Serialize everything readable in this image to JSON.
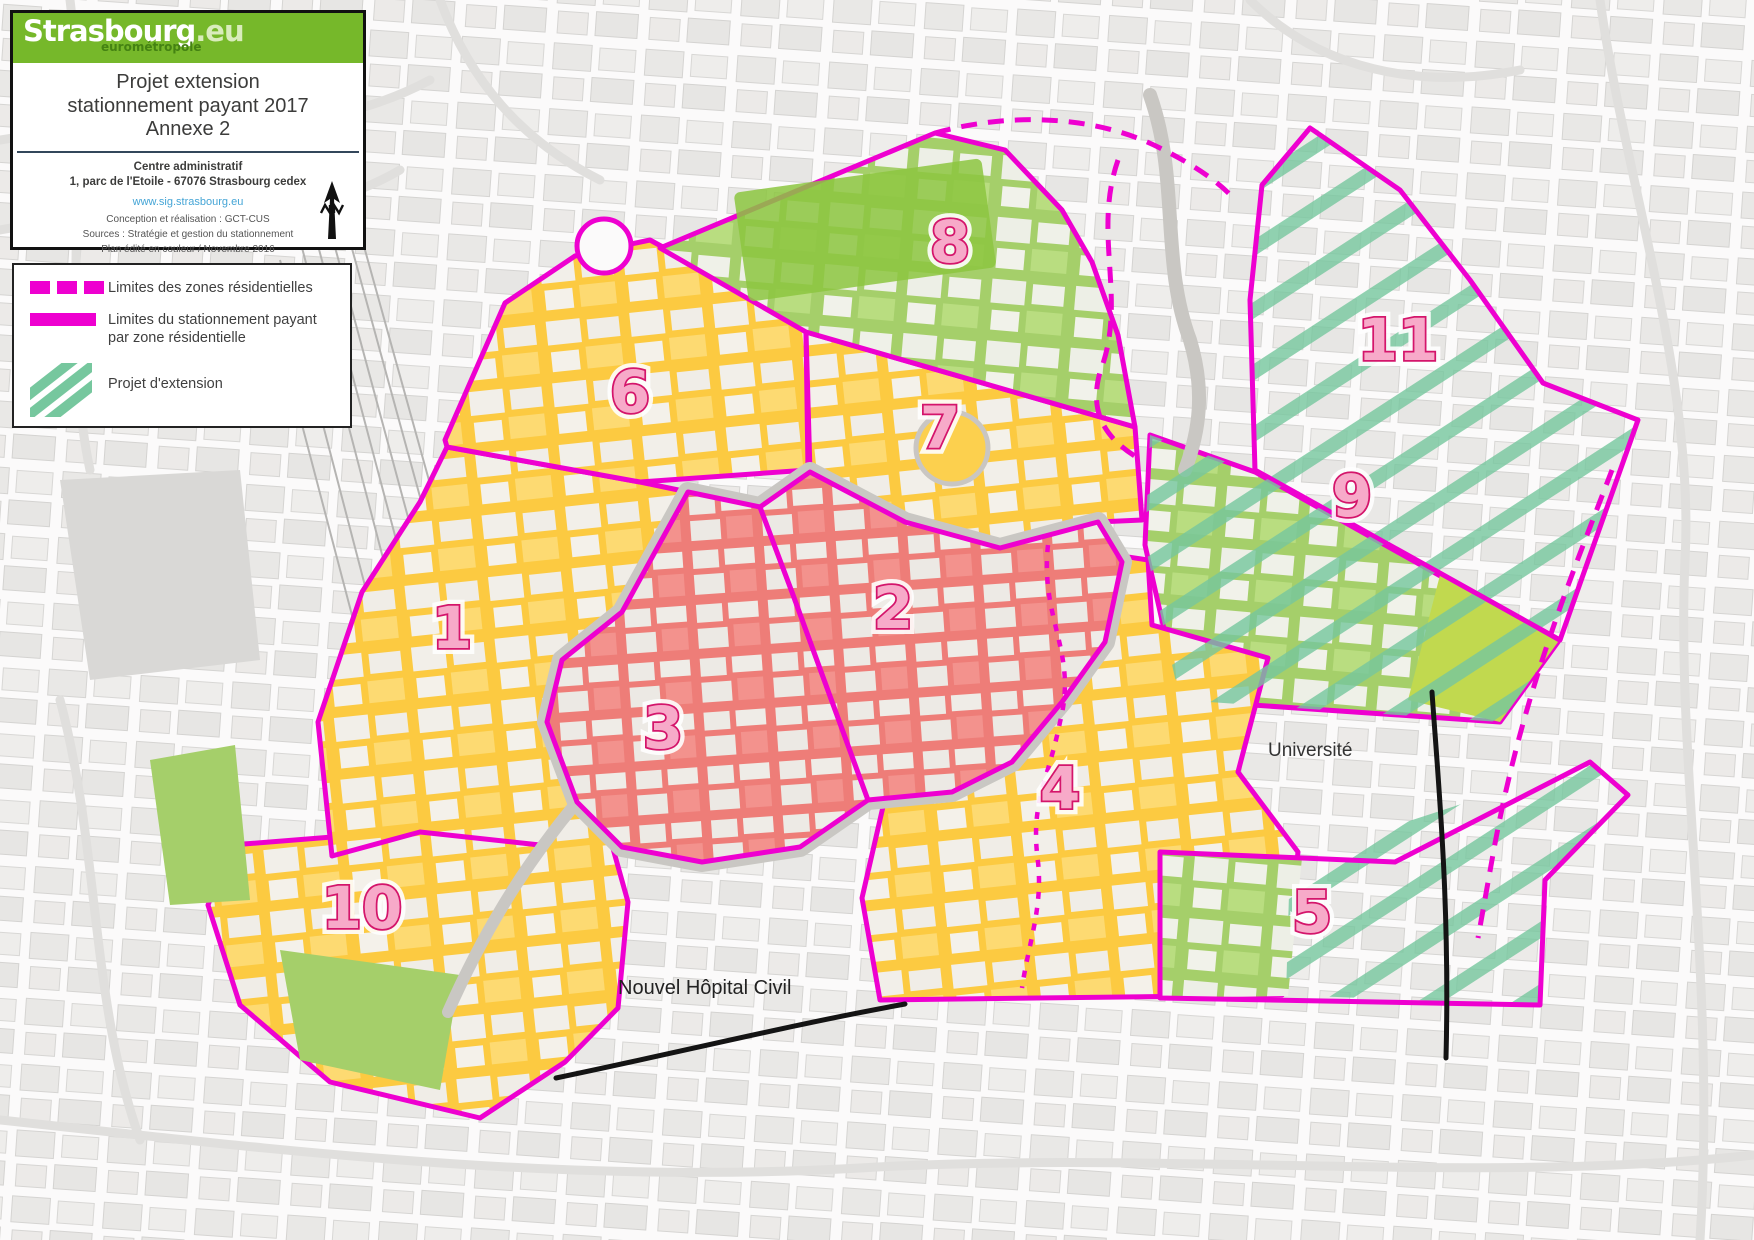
{
  "page_title": "Projet extension stationnement payant 2017 - Annexe 2",
  "title_box": {
    "logo_brand": "Strasbourg",
    "logo_tld": ".eu",
    "logo_subbrand": "eurométropole",
    "title_line1": "Projet extension",
    "title_line2": "stationnement payant 2017",
    "title_line3": "Annexe 2",
    "address_line1": "Centre administratif",
    "address_line2": "1, parc de l'Etoile - 67076 Strasbourg cedex",
    "website": "www.sig.strasbourg.eu",
    "credit_line1": "Conception et réalisation : GCT-CUS",
    "credit_line2": "Sources : Stratégie et gestion du stationnement",
    "credit_line3": "Plan édité en couleur / Novembre 2016"
  },
  "legend": {
    "item1_label": "Limites des zones résidentielles",
    "item2_label": "Limites du stationnement payant par zone résidentielle",
    "item3_label": "Projet d'extension"
  },
  "map": {
    "zone_numbers": {
      "z1": "1",
      "z2": "2",
      "z3": "3",
      "z4": "4",
      "z5": "5",
      "z6": "6",
      "z7": "7",
      "z8": "8",
      "z9": "9",
      "z10": "10",
      "z11": "11"
    },
    "labels": {
      "universite": "Université",
      "hopital": "Nouvel Hôpital Civil"
    }
  },
  "colors": {
    "boundary_magenta": "#ee00d0",
    "zone_paid_yellow": "#fcca41",
    "zone_green": "#a5cf6a",
    "zone_center_red": "#ee7d78",
    "extension_hatch_green": "#76c79e",
    "zone_number_pink": "#f7aac9",
    "zone_number_outline": "#d4156b",
    "logo_green": "#76b82a"
  }
}
